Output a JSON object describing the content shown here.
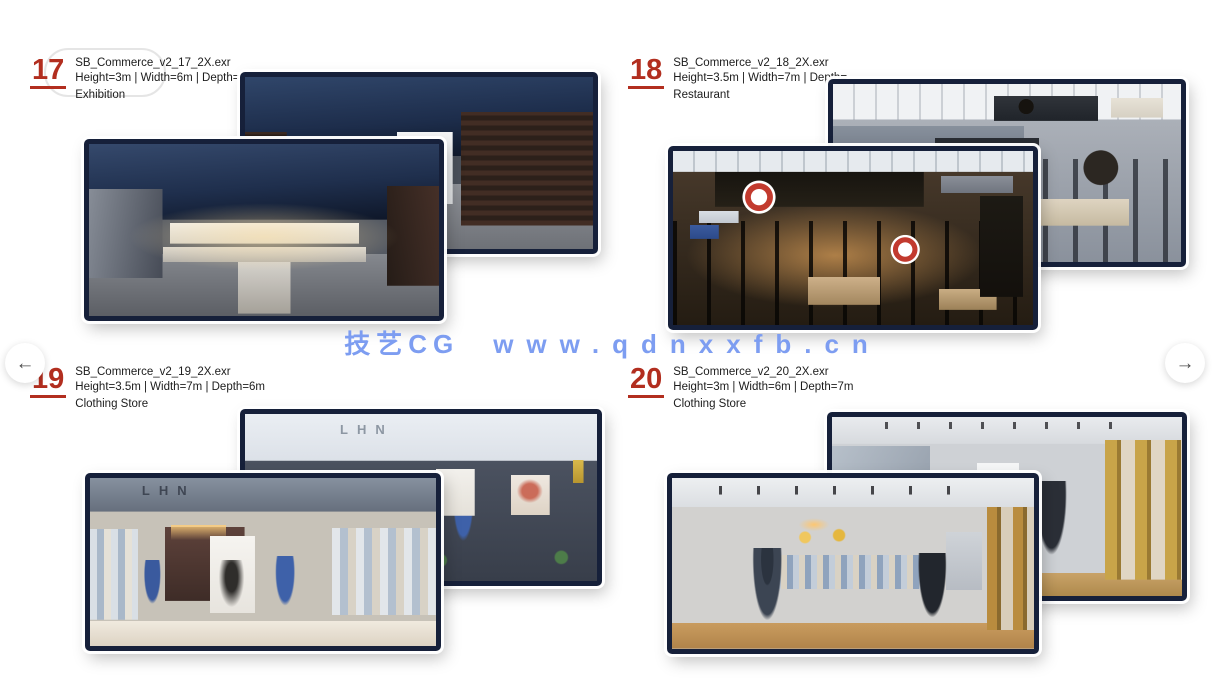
{
  "watermark": {
    "brand": "技艺CG",
    "site": "www.qdnxxfb.cn",
    "color": "#7d9df1"
  },
  "navigation": {
    "prev": "←",
    "next": "→"
  },
  "accent_color": "#b22e1f",
  "items": [
    {
      "number": "17",
      "filename": "SB_Commerce_v2_17_2X.exr",
      "dimensions": "Height=3m | Width=6m | Depth=1",
      "category": "Exhibition"
    },
    {
      "number": "18",
      "filename": "SB_Commerce_v2_18_2X.exr",
      "dimensions": "Height=3.5m | Width=7m | Depth=",
      "category": "Restaurant"
    },
    {
      "number": "19",
      "filename": "SB_Commerce_v2_19_2X.exr",
      "dimensions": "Height=3.5m | Width=7m | Depth=6m",
      "category": "Clothing Store"
    },
    {
      "number": "20",
      "filename": "SB_Commerce_v2_20_2X.exr",
      "dimensions": "Height=3m | Width=6m | Depth=7m",
      "category": "Clothing Store"
    }
  ],
  "scene_signs": {
    "clothing_logo": "LHN"
  }
}
